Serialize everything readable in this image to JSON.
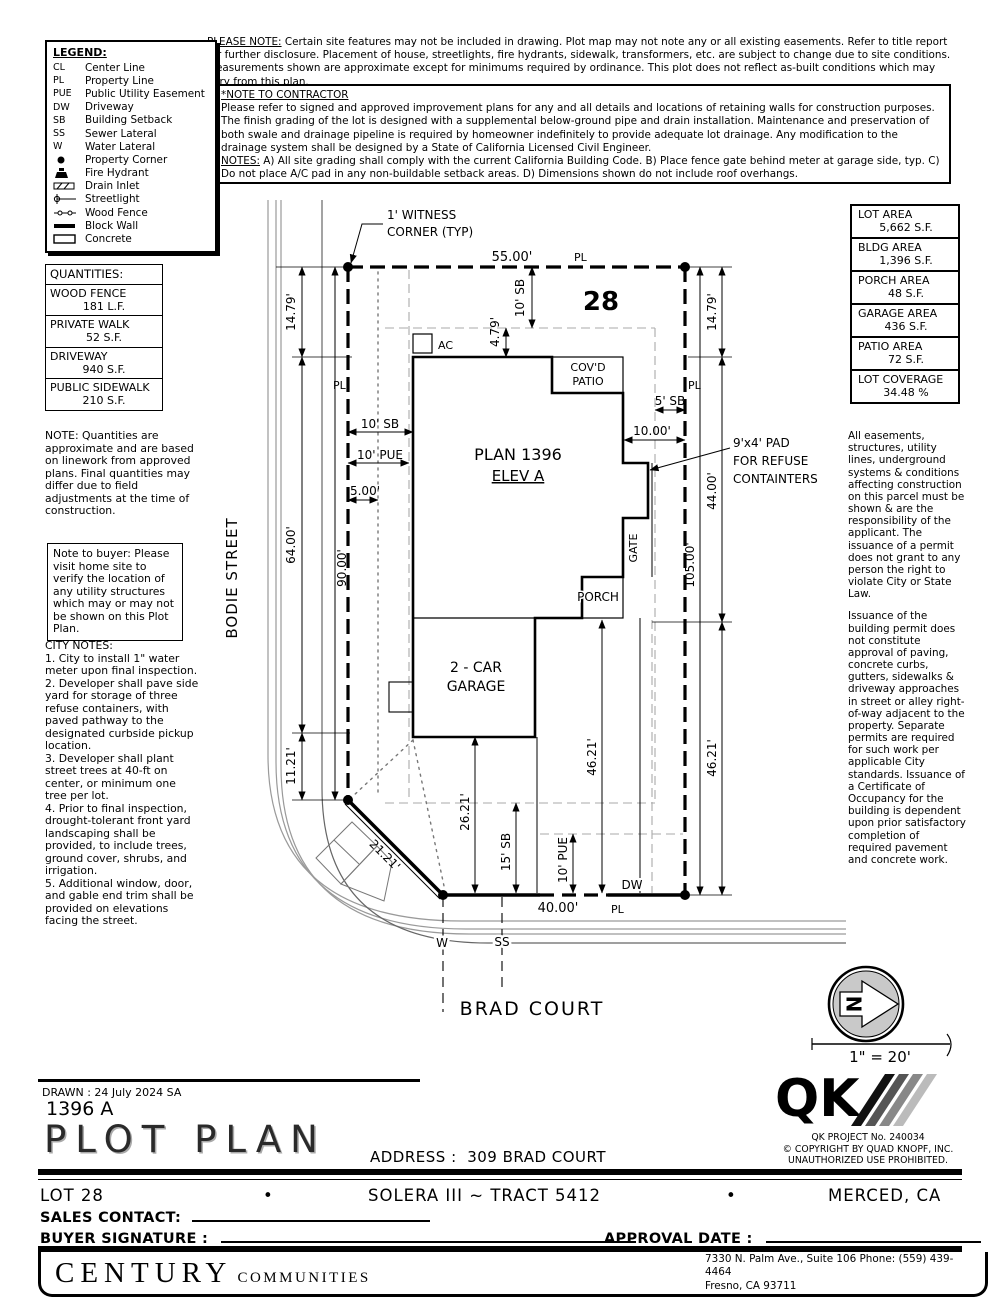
{
  "notes": {
    "please_note_label": "PLEASE NOTE:",
    "please_note_text": " Certain site features may not be included in drawing.  Plot map may not note any or all existing easements. Refer to title report for further disclosure.  Placement of house, streetlights, fire hydrants, sidewalk, transformers, etc. are subject to change due to site conditions.  Measurements shown are approximate except for minimums required by ordinance.  This plot does not reflect as-built conditions which may vary from this plan.",
    "contractor_label": "*NOTE TO CONTRACTOR",
    "contractor_p1": "Please refer to signed and approved improvement plans for any and all details and locations of retaining walls for construction purposes.",
    "contractor_p2": "The finish grading of the lot is designed with a supplemental below-ground pipe and drain installation.  Maintenance and preservation of both swale and drainage pipeline is required by homeowner indefinitely to provide adequate lot drainage.  Any modification to the drainage system shall be designed by a State of California Licensed Civil Engineer.",
    "contractor_notes_label": "NOTES:",
    "contractor_notes_text": " A) All site grading shall comply with the current California Building Code.  B) Place fence gate behind meter at garage side, typ.  C) Do not place A/C pad in any non-buildable setback areas.  D) Dimensions shown do not include roof overhangs.",
    "quantities_note": "NOTE: Quantities are approximate and are based on linework from approved plans.  Final quantities may differ due to field adjustments at the time of construction.",
    "buyer_note": "Note to buyer: Please visit home site to verify the location of any utility structures which may or may not be shown on this Plot Plan."
  },
  "legend": {
    "title": "LEGEND:",
    "items": [
      {
        "symbol": "CL",
        "label": "Center Line"
      },
      {
        "symbol": "PL",
        "label": "Property Line"
      },
      {
        "symbol": "PUE",
        "label": "Public Utility Easement"
      },
      {
        "symbol": "DW",
        "label": "Driveway"
      },
      {
        "symbol": "SB",
        "label": "Building Setback"
      },
      {
        "symbol": "SS",
        "label": "Sewer Lateral"
      },
      {
        "symbol": "W",
        "label": "Water Lateral"
      },
      {
        "symbol": "property-corner",
        "label": "Property Corner"
      },
      {
        "symbol": "fire-hydrant",
        "label": "Fire Hydrant"
      },
      {
        "symbol": "drain-inlet",
        "label": "Drain Inlet"
      },
      {
        "symbol": "streetlight",
        "label": "Streetlight"
      },
      {
        "symbol": "wood-fence",
        "label": "Wood Fence"
      },
      {
        "symbol": "block-wall",
        "label": "Block Wall"
      },
      {
        "symbol": "concrete",
        "label": "Concrete"
      }
    ]
  },
  "quantities": {
    "title": "QUANTITIES:",
    "rows": [
      {
        "name": "WOOD FENCE",
        "value": "181 L.F."
      },
      {
        "name": "PRIVATE WALK",
        "value": "52 S.F."
      },
      {
        "name": "DRIVEWAY",
        "value": "940 S.F."
      },
      {
        "name": "PUBLIC SIDEWALK",
        "value": "210 S.F."
      }
    ]
  },
  "areas": {
    "rows": [
      {
        "name": "LOT AREA",
        "value": "5,662 S.F."
      },
      {
        "name": "BLDG AREA",
        "value": "1,396 S.F."
      },
      {
        "name": "PORCH AREA",
        "value": "48 S.F."
      },
      {
        "name": "GARAGE AREA",
        "value": "436 S.F."
      },
      {
        "name": "PATIO AREA",
        "value": "72 S.F."
      },
      {
        "name": "LOT COVERAGE",
        "value": "34.48 %"
      }
    ]
  },
  "city_notes": {
    "title": "CITY NOTES:",
    "items": [
      "1. City to install 1\" water meter upon final inspection.",
      "2. Developer shall pave side yard for storage of three refuse containers, with paved pathway to the designated curbside pickup location.",
      "3. Developer shall plant street trees at 40-ft on center, or minimum one tree per lot.",
      "4. Prior to final inspection, drought-tolerant front yard landscaping shall be provided, to include trees, ground cover, shrubs, and irrigation.",
      "5. Additional window, door, and gable end trim shall be provided on elevations facing the street."
    ]
  },
  "right_notes": {
    "p1": "All easements, structures, utility lines, underground systems & conditions affecting construction on this parcel must be shown & are the responsibility of the applicant. The issuance of a permit does not grant to any person the right to violate City or State Law.",
    "p2": "Issuance of the building permit does not constitute approval of paving, concrete curbs, gutters, sidewalks & driveway approaches in street or alley right-of-way adjacent to the property. Separate permits are required for such work per applicable City standards. Issuance of a Certificate of Occupancy for the building is dependent upon prior satisfactory completion of required pavement and concrete work."
  },
  "plan": {
    "witness1": "1' WITNESS",
    "witness2": "CORNER (TYP)",
    "lot_number": "28",
    "pl": "PL",
    "dim_top": "55.00'",
    "dim_left_1479": "14.79'",
    "dim_left_64": "64.00'",
    "dim_left_1121": "11.21'",
    "dim_left_90": "90.00'",
    "dim_right_1479": "14.79'",
    "dim_right_44": "44.00'",
    "dim_right_4621": "46.21'",
    "dim_right_105": "105.00'",
    "dim_inner_4621": "46.21'",
    "dim_10sb_top": "10' SB",
    "dim_479": "4.79'",
    "dim_10sb_left": "10' SB",
    "dim_10pue_left": "10' PUE",
    "dim_500": "5.00'",
    "dim_5sb": "5' SB",
    "dim_1000": "10.00'",
    "dim_2621": "26.21'",
    "dim_15sb": "15' SB",
    "dim_10pue_bottom": "10' PUE",
    "dim_4000": "40.00'",
    "dim_2121": "21.21'",
    "ac": "AC",
    "covd": "COV'D",
    "patio": "PATIO",
    "plan_name": "PLAN 1396",
    "elev": "ELEV A",
    "porch": "PORCH",
    "gate": "GATE",
    "garage1": "2 - CAR",
    "garage2": "GARAGE",
    "dw": "DW",
    "w": "W",
    "ss": "SS",
    "refuse1": "9'x4' PAD",
    "refuse2": "FOR REFUSE",
    "refuse3": "CONTAINTERS",
    "street_left": "BODIE STREET",
    "street_bottom": "BRAD COURT",
    "north": "N",
    "scale": "1\" = 20'"
  },
  "titleblock": {
    "drawn": "DRAWN :  24 July 2024  SA",
    "plan_number": "1396  A",
    "title": "PLOT PLAN",
    "address_label": "ADDRESS :",
    "address_value": "309 BRAD COURT",
    "qk": "QK",
    "qk_project": "QK PROJECT No. 240034",
    "copyright1": "©  COPYRIGHT BY QUAD KNOPF, INC.",
    "copyright2": "UNAUTHORIZED USE PROHIBITED.",
    "lot": "LOT 28",
    "bullet1": "•",
    "tract": "SOLERA III ~ TRACT 5412",
    "bullet2": "•",
    "city": "MERCED, CA",
    "sales_contact_label": "SALES CONTACT:",
    "buyer_signature_label": "BUYER SIGNATURE :",
    "approval_date_label": "APPROVAL DATE :"
  },
  "footer": {
    "brand_primary": "CENTURY",
    "brand_secondary": "COMMUNITIES",
    "address_line1": "7330 N. Palm Ave., Suite 106    Phone:  (559) 439-4464",
    "address_line2": "Fresno, CA  93711"
  }
}
